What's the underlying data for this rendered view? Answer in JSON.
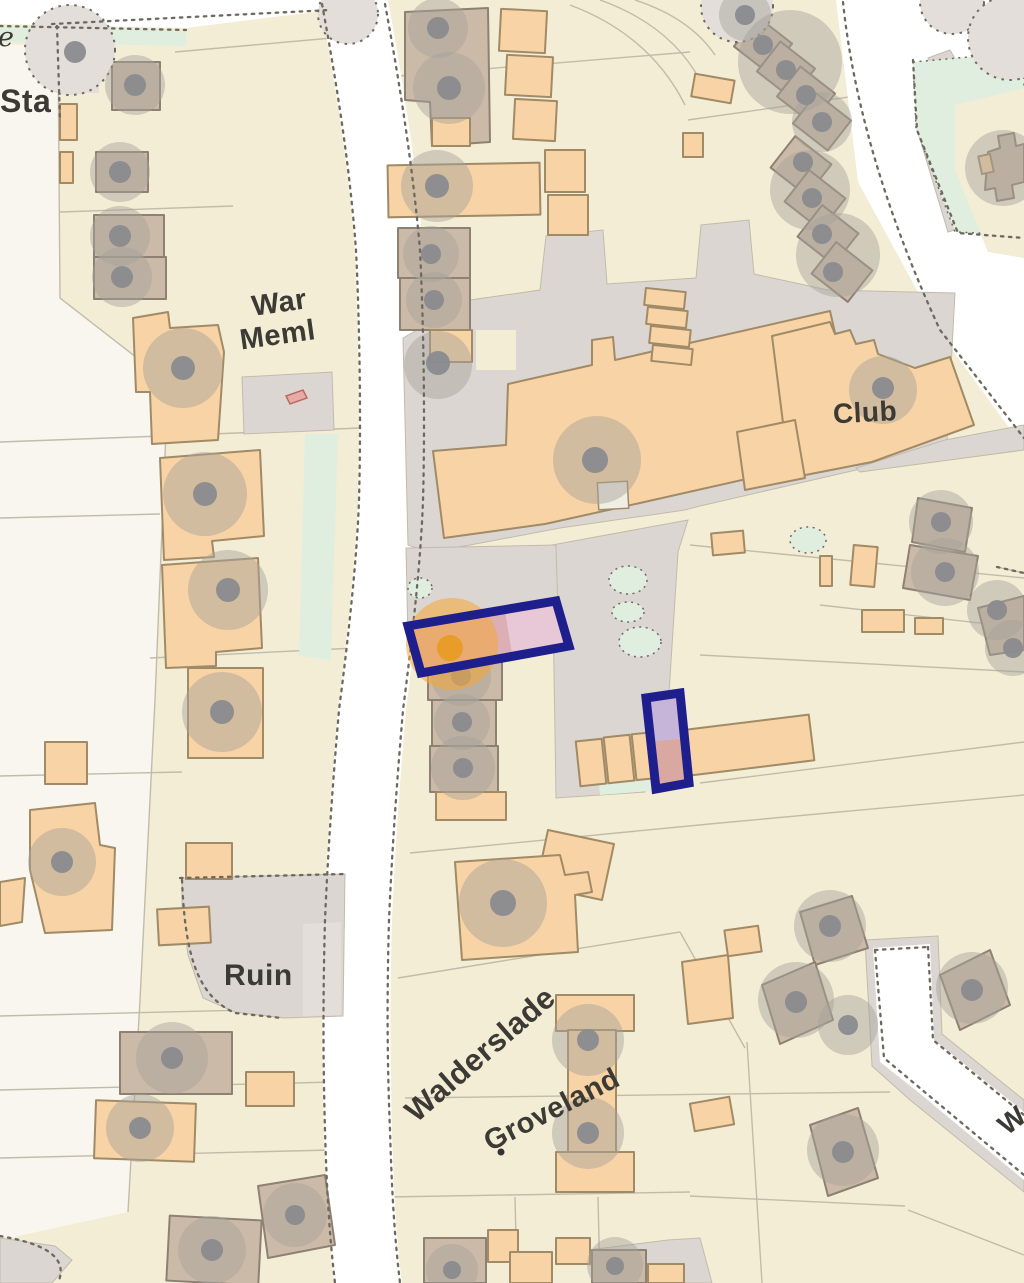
{
  "map": {
    "labels": {
      "sta": "Sta",
      "e": "e",
      "war_line1": "War",
      "war_line2": "Meml",
      "club": "Club",
      "ruin": "Ruin",
      "walderslade": "Walderslade",
      "groveland": "Groveland",
      "w_partial": "W"
    },
    "colors": {
      "cream": "#f3edd5",
      "offwhite": "#f8f6ee",
      "road_white": "#ffffff",
      "gray_area": "#dcd6d2",
      "gray_light": "#e3deda",
      "mint": "#dfeedf",
      "peach": "#f8d3a5",
      "peach_stroke": "#a18a66",
      "tan": "#ccbaa8",
      "tan_stroke": "#8d8174",
      "tree": "#a8a29b",
      "tree_dot": "#8a8b8f",
      "boundary": "#c2bbaa",
      "dots": "#6e695f",
      "navy": "#1e1f8c",
      "plot_pink": "#dcaeb5",
      "plot_pink_light": "#e8c8d6",
      "plot_lavender": "#c7b4d9",
      "plot_salmon": "#d8a8a1",
      "marker_orange": "#f3a93c",
      "marker_orange_dot": "#e8991f",
      "meml_pink": "#e9aaa6",
      "meml_stroke": "#b96a62",
      "text": "#3c3a35"
    }
  }
}
